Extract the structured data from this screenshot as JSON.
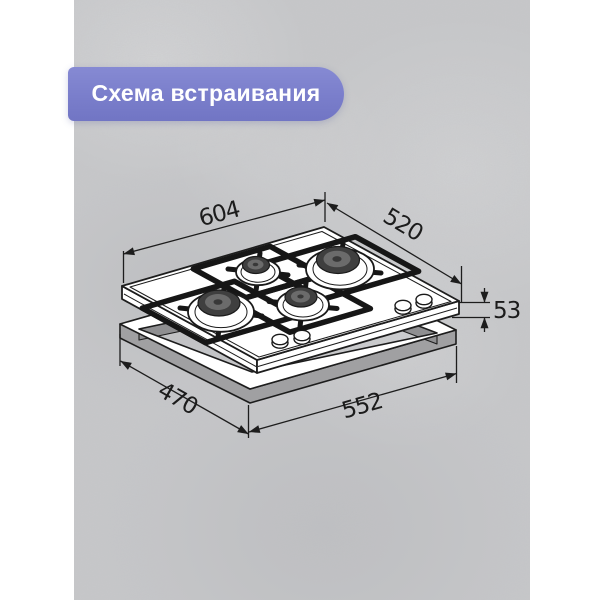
{
  "badge": {
    "label": "Схема встраивания"
  },
  "colors": {
    "badge_accent": "#7a7ecb",
    "badge_text": "#ffffff",
    "line_art": "#1d1d1d",
    "concrete": "#c6c7c9",
    "frame_side_gray": "#a0a0a2",
    "frame_inner_gray": "#8f8f91",
    "burner_cap_gray": "#3f3f3f"
  },
  "diagram": {
    "type": "hob-built-in-installation-scheme",
    "dims": {
      "top_width": "604",
      "top_depth": "520",
      "height": "53",
      "cutout_length": "552",
      "cutout_depth": "470"
    }
  }
}
